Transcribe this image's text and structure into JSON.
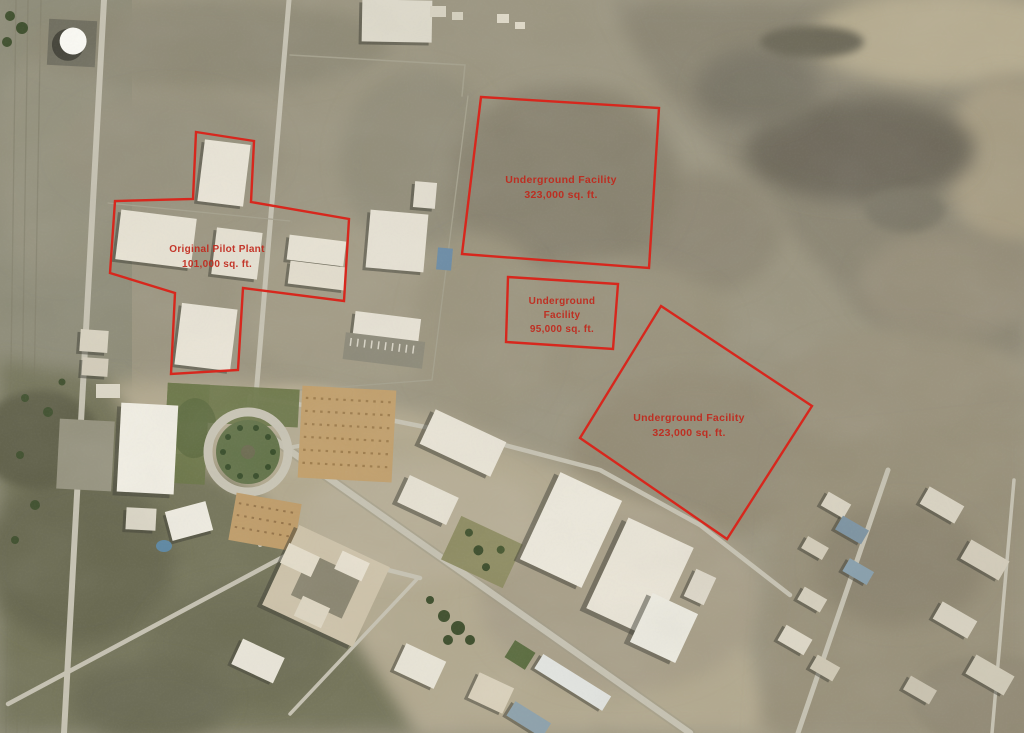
{
  "scene": {
    "type": "annotated-satellite-photo",
    "description": "Aerial satellite view of a desert industrial/nuclear facility. Red analyst annotations outline a cross-shaped pilot plant building complex and three large underground facility footprints in the open dirt field.",
    "annotation_color": "#d7271d",
    "label_color": "#c1281c"
  },
  "annotations": [
    {
      "id": "original-pilot-plant",
      "shape": "cross-outline",
      "points": "196,132 254,141 251,202 349,219 344,301 243,288 238,370 171,374 175,293 110,273 115,201 193,199",
      "lines": [
        "Original Pilot Plant",
        "101,000 sq. ft."
      ]
    },
    {
      "id": "underground-facility-north",
      "shape": "rectangle-outline",
      "points": "481,97 659,108 649,268 462,254",
      "lines": [
        "Underground Facility",
        "323,000 sq. ft."
      ]
    },
    {
      "id": "underground-facility-central",
      "shape": "rectangle-outline",
      "points": "508,277 618,284 613,349 506,342",
      "lines": [
        "Underground",
        "Facility",
        "95,000 sq. ft."
      ]
    },
    {
      "id": "underground-facility-south",
      "shape": "rotated-square-outline",
      "points": "661,306 812,406 727,539 580,438",
      "lines": [
        "Underground Facility",
        "323,000 sq. ft."
      ]
    }
  ]
}
